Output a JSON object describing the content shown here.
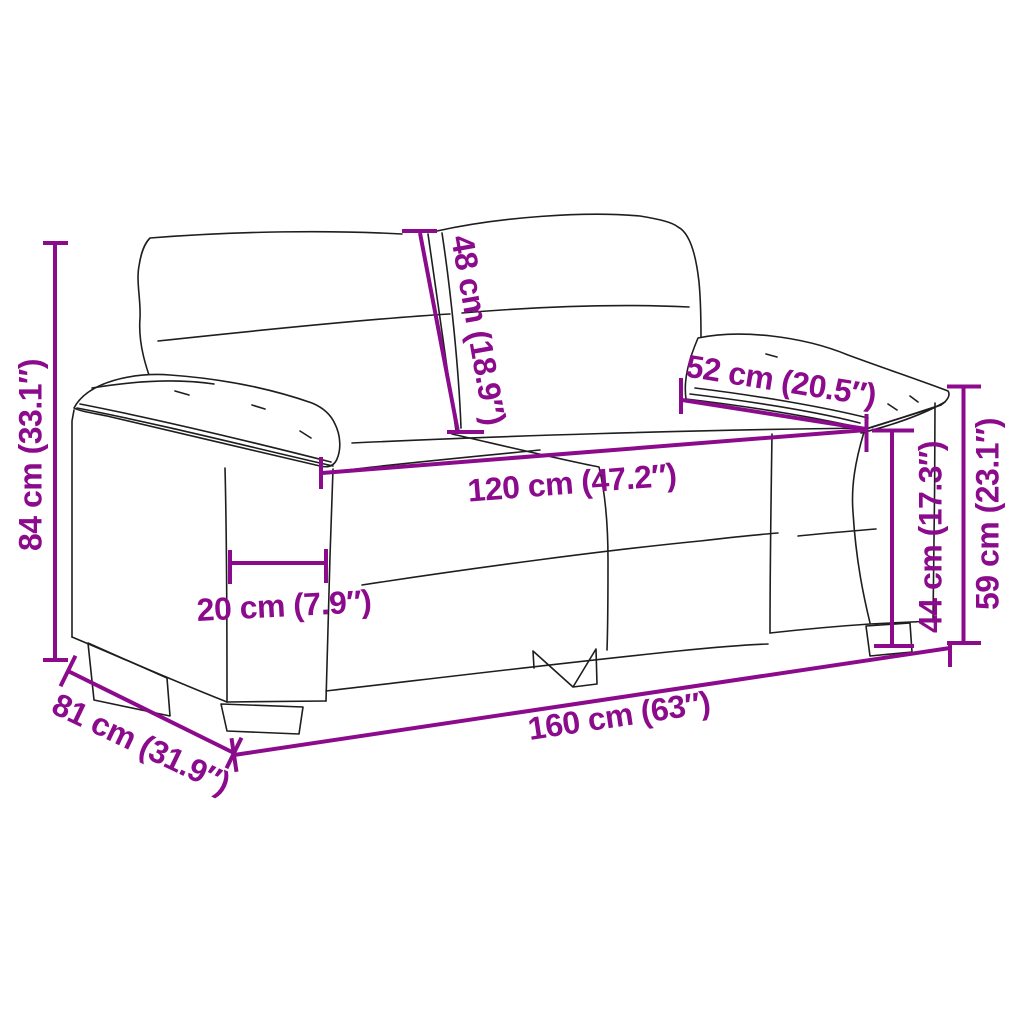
{
  "colors": {
    "accent": "#8B0B8C",
    "ink": "#1E1E1E",
    "bg": "#FFFFFF"
  },
  "diagram": {
    "subject": "2-seater sofa dimension drawing",
    "dimensions": {
      "overall_height": {
        "label": "84 cm (33.1″)",
        "value_cm": 84,
        "value_in": 33.1
      },
      "back_cushion": {
        "label": "48 cm (18.9″)",
        "value_cm": 48,
        "value_in": 18.9
      },
      "armrest_top_depth": {
        "label": "52 cm (20.5″)",
        "value_cm": 52,
        "value_in": 20.5
      },
      "seat_width": {
        "label": "120 cm (47.2″)",
        "value_cm": 120,
        "value_in": 47.2
      },
      "armrest_width": {
        "label": "20 cm (7.9″)",
        "value_cm": 20,
        "value_in": 7.9
      },
      "seat_back_height": {
        "label": "44 cm (17.3″)",
        "value_cm": 44,
        "value_in": 17.3
      },
      "armrest_height": {
        "label": "59 cm (23.1″)",
        "value_cm": 59,
        "value_in": 23.1
      },
      "overall_depth": {
        "label": "81 cm (31.9″)",
        "value_cm": 81,
        "value_in": 31.9
      },
      "overall_width": {
        "label": "160 cm (63″)",
        "value_cm": 160,
        "value_in": 63
      }
    }
  }
}
